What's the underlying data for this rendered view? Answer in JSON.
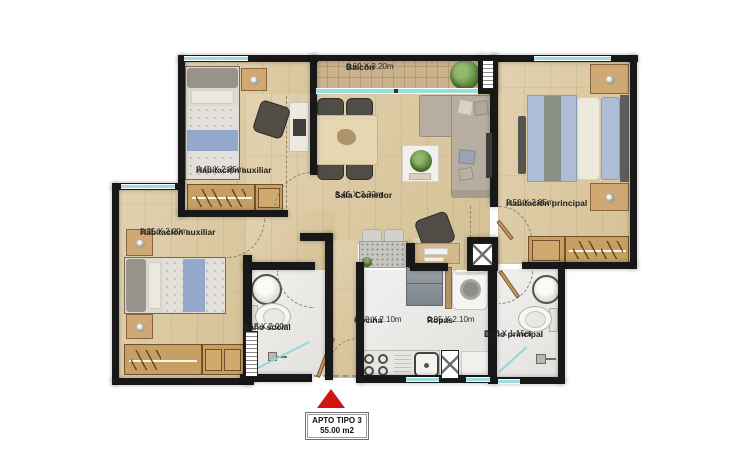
{
  "plan": {
    "marker": {
      "type_label": "APTO TIPO 3",
      "area_label": "55.00 m2"
    },
    "rooms": {
      "hab_aux_1": {
        "name": "Habitación auxiliar",
        "dims": "2.40 X 2.85m"
      },
      "balcon": {
        "name": "Balcón",
        "dims": "0.60 X 3.20m"
      },
      "hab_principal": {
        "name": "Habitación principal",
        "dims": "2.50 X 3.85m"
      },
      "sala_comedor": {
        "name": "Sala Comedor",
        "dims": "3.45 X 3.32m"
      },
      "hab_aux_2": {
        "name": "Habitación auxiliar",
        "dims": "2.35 X 3.00m"
      },
      "bano_social": {
        "name": "Baño social",
        "dims": "1.15 X 2.00m"
      },
      "cocina": {
        "name": "Cocina",
        "dims": "1.60 X 2.10m"
      },
      "ropas": {
        "name": "Ropas",
        "dims": "0.95 X 2.10m"
      },
      "bano_principal": {
        "name": "Baño principal",
        "dims": "2.10 X 1.15m"
      }
    },
    "colors": {
      "wall": "#181818",
      "window": "#9adde0",
      "wood_floor": "#d9c7a2",
      "tile_floor": "#eceae7",
      "balcony_floor": "#c9b28c",
      "marker_red": "#d01410"
    }
  }
}
